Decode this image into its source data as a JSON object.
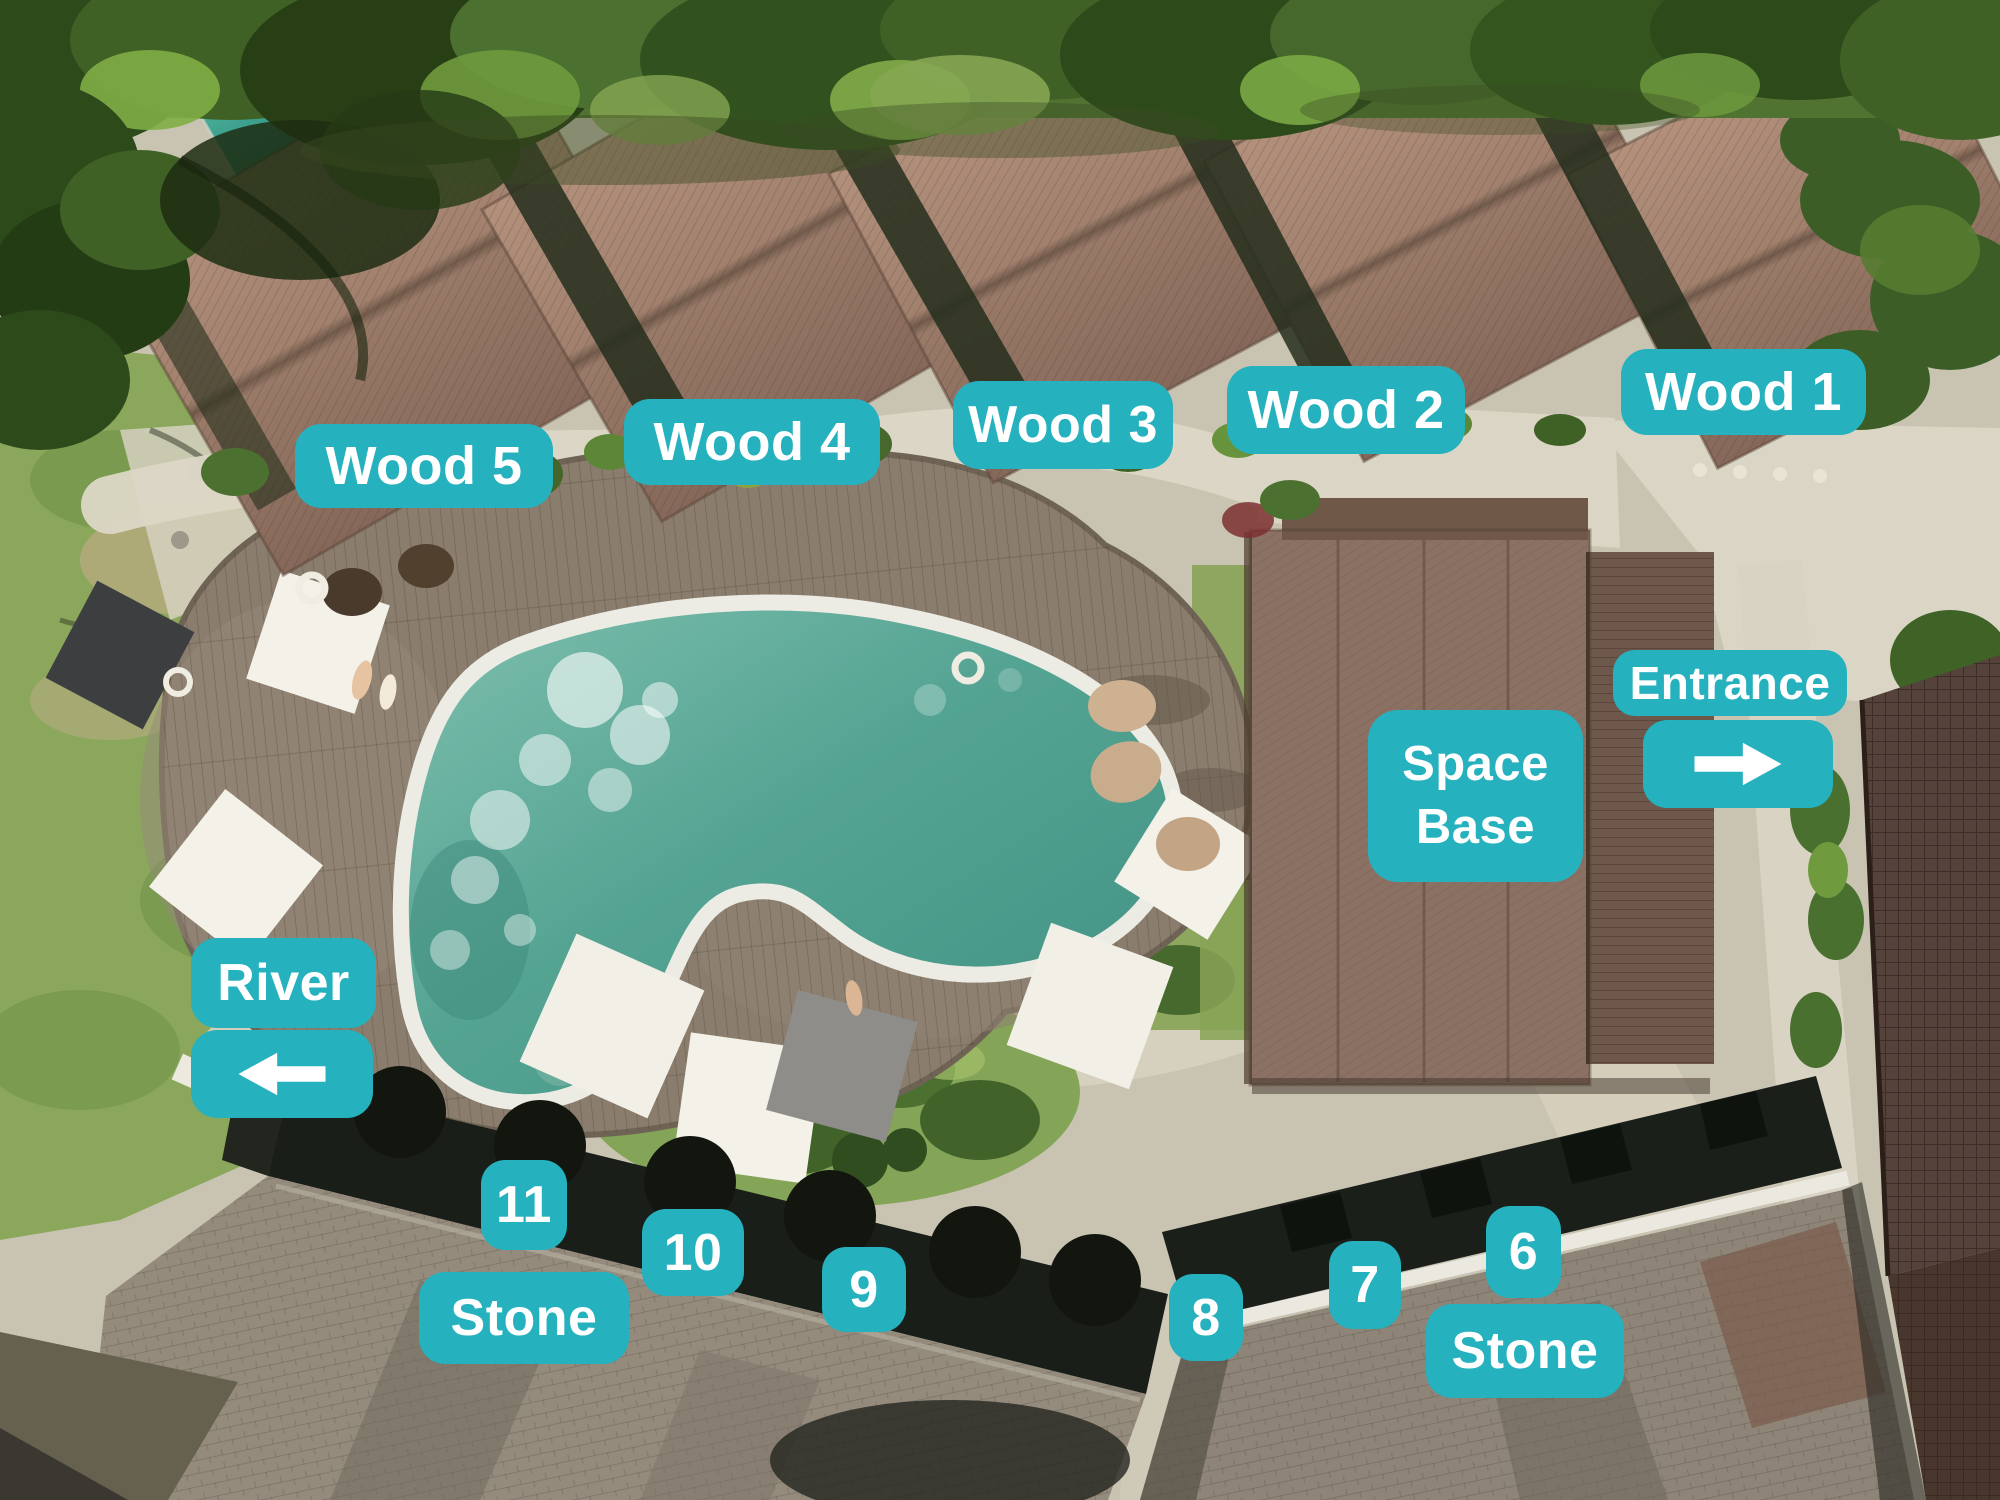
{
  "colors": {
    "accent": "#25b1bd",
    "label_text": "#ffffff",
    "pool_water": "#55a493",
    "pool_rim": "#edece4",
    "deck_wood": "#8a7d6d",
    "villa_roof": "#a1816e",
    "stone_roof": "#948b7d",
    "foliage": "#3f6126",
    "grass": "#8ba75c"
  },
  "labels": {
    "wood5": "Wood 5",
    "wood4": "Wood 4",
    "wood3": "Wood 3",
    "wood2": "Wood 2",
    "wood1": "Wood 1",
    "space_base_line1": "Space",
    "space_base_line2": "Base",
    "entrance": "Entrance",
    "river": "River",
    "stone_west": "Stone",
    "stone_east": "Stone",
    "unit11": "11",
    "unit10": "10",
    "unit9": "9",
    "unit8": "8",
    "unit7": "7",
    "unit6": "6"
  },
  "icons": {
    "entrance_arrow": "arrow-right",
    "river_arrow": "arrow-left"
  }
}
